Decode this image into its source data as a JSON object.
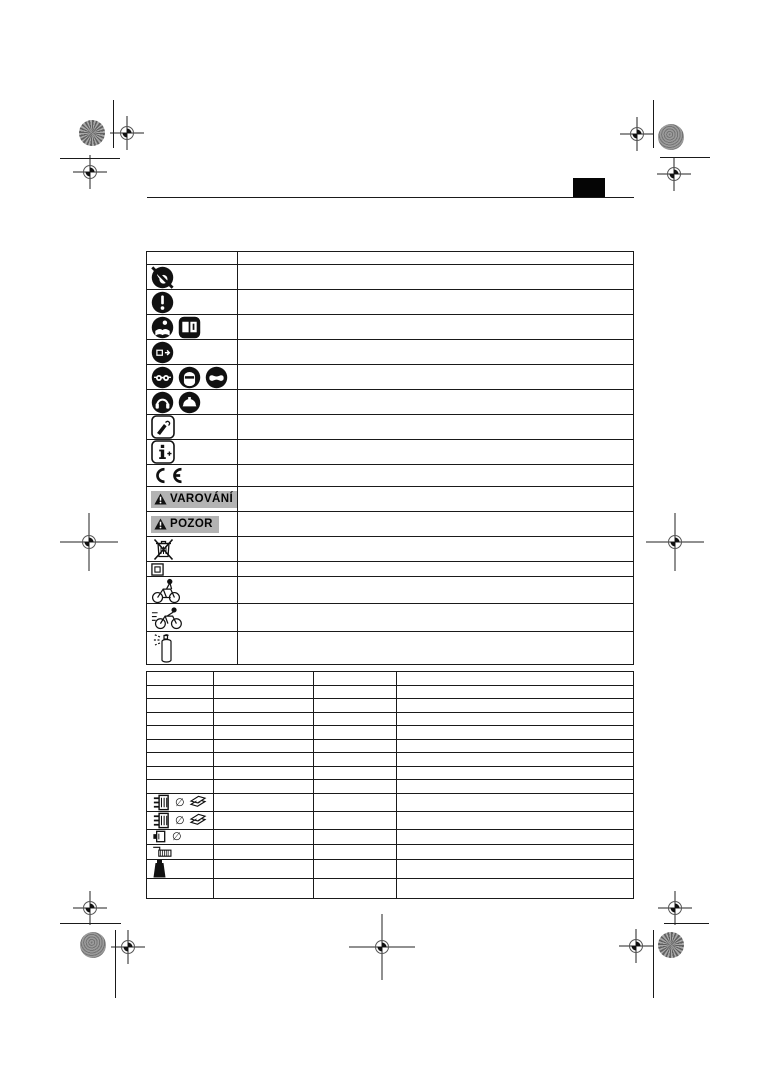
{
  "page": {
    "kind": "print-proof manual page with safety-symbol table and technical-data table",
    "language_tab_label": "",
    "colors": {
      "line": "#1a1a1a",
      "badge_bg": "#b3b3b3",
      "patch_gray": "#8a8a8a",
      "tab_black": "#050505"
    }
  },
  "labels": {
    "warning": "VAROVÁNÍ",
    "caution": "POZOR"
  },
  "symbols_table": {
    "header": [
      "",
      ""
    ],
    "rows": [
      {
        "kind": "header",
        "icons": [],
        "badge": null,
        "text": ""
      },
      {
        "kind": "std",
        "icons": [
          "no-touch-icon"
        ],
        "badge": null,
        "text": ""
      },
      {
        "kind": "std",
        "icons": [
          "exclamation-icon"
        ],
        "badge": null,
        "text": ""
      },
      {
        "kind": "std",
        "icons": [
          "read-instructions-icon",
          "manual-book-icon"
        ],
        "badge": null,
        "text": ""
      },
      {
        "kind": "std",
        "icons": [
          "remove-battery-icon"
        ],
        "badge": null,
        "text": ""
      },
      {
        "kind": "std",
        "icons": [
          "eye-protection-icon",
          "face-protection-icon",
          "goggles-icon"
        ],
        "badge": null,
        "text": ""
      },
      {
        "kind": "std",
        "icons": [
          "ear-protection-icon",
          "head-protection-icon"
        ],
        "badge": null,
        "text": ""
      },
      {
        "kind": "std",
        "icons": [
          "hand-press-icon"
        ],
        "badge": null,
        "text": ""
      },
      {
        "kind": "std",
        "icons": [
          "info-plus-icon"
        ],
        "badge": null,
        "text": ""
      },
      {
        "kind": "ce",
        "icons": [
          "ce-mark-icon"
        ],
        "badge": null,
        "text": ""
      },
      {
        "kind": "std",
        "icons": [],
        "badge": "VAROVÁNÍ",
        "text": ""
      },
      {
        "kind": "std",
        "icons": [],
        "badge": "POZOR",
        "text": ""
      },
      {
        "kind": "std",
        "icons": [
          "weee-bin-icon"
        ],
        "badge": null,
        "text": ""
      },
      {
        "kind": "compact",
        "icons": [
          "protection-class-2-icon"
        ],
        "badge": null,
        "text": ""
      },
      {
        "kind": "bike",
        "icons": [
          "ebike-rider-icon"
        ],
        "badge": null,
        "text": ""
      },
      {
        "kind": "race",
        "icons": [
          "speed-ebike-icon"
        ],
        "badge": null,
        "text": ""
      },
      {
        "kind": "spray",
        "icons": [
          "spray-can-icon"
        ],
        "badge": null,
        "text": ""
      }
    ]
  },
  "tech_table": {
    "columns": [
      "",
      "",
      "",
      ""
    ],
    "rows": [
      {
        "size": "s",
        "icons": [],
        "cells": [
          "",
          "",
          "",
          ""
        ]
      },
      {
        "size": "s",
        "icons": [],
        "cells": [
          "",
          "",
          "",
          ""
        ]
      },
      {
        "size": "s",
        "icons": [],
        "cells": [
          "",
          "",
          "",
          ""
        ]
      },
      {
        "size": "s",
        "icons": [],
        "cells": [
          "",
          "",
          "",
          ""
        ]
      },
      {
        "size": "s",
        "icons": [],
        "cells": [
          "",
          "",
          "",
          ""
        ]
      },
      {
        "size": "s",
        "icons": [],
        "cells": [
          "",
          "",
          "",
          ""
        ]
      },
      {
        "size": "s",
        "icons": [],
        "cells": [
          "",
          "",
          "",
          ""
        ]
      },
      {
        "size": "s",
        "icons": [],
        "cells": [
          "",
          "",
          "",
          ""
        ]
      },
      {
        "size": "s",
        "icons": [],
        "cells": [
          "",
          "",
          "",
          ""
        ]
      },
      {
        "size": "l",
        "icons": [
          "cassette-icon",
          "diameter-icon",
          "chainring-icon"
        ],
        "cells": [
          "",
          "",
          "",
          ""
        ]
      },
      {
        "size": "l",
        "icons": [
          "cassette-icon",
          "diameter-icon",
          "chainring-icon"
        ],
        "cells": [
          "",
          "",
          "",
          ""
        ]
      },
      {
        "size": "m",
        "icons": [
          "hub-icon",
          "diameter-icon"
        ],
        "cells": [
          "",
          "",
          "",
          ""
        ]
      },
      {
        "size": "m",
        "icons": [
          "axle-tool-icon"
        ],
        "cells": [
          "",
          "",
          "",
          ""
        ]
      },
      {
        "size": "xl",
        "icons": [
          "weight-icon"
        ],
        "cells": [
          "",
          "",
          "",
          ""
        ]
      },
      {
        "size": "xl",
        "icons": [],
        "cells": [
          "",
          "",
          "",
          ""
        ]
      }
    ]
  }
}
